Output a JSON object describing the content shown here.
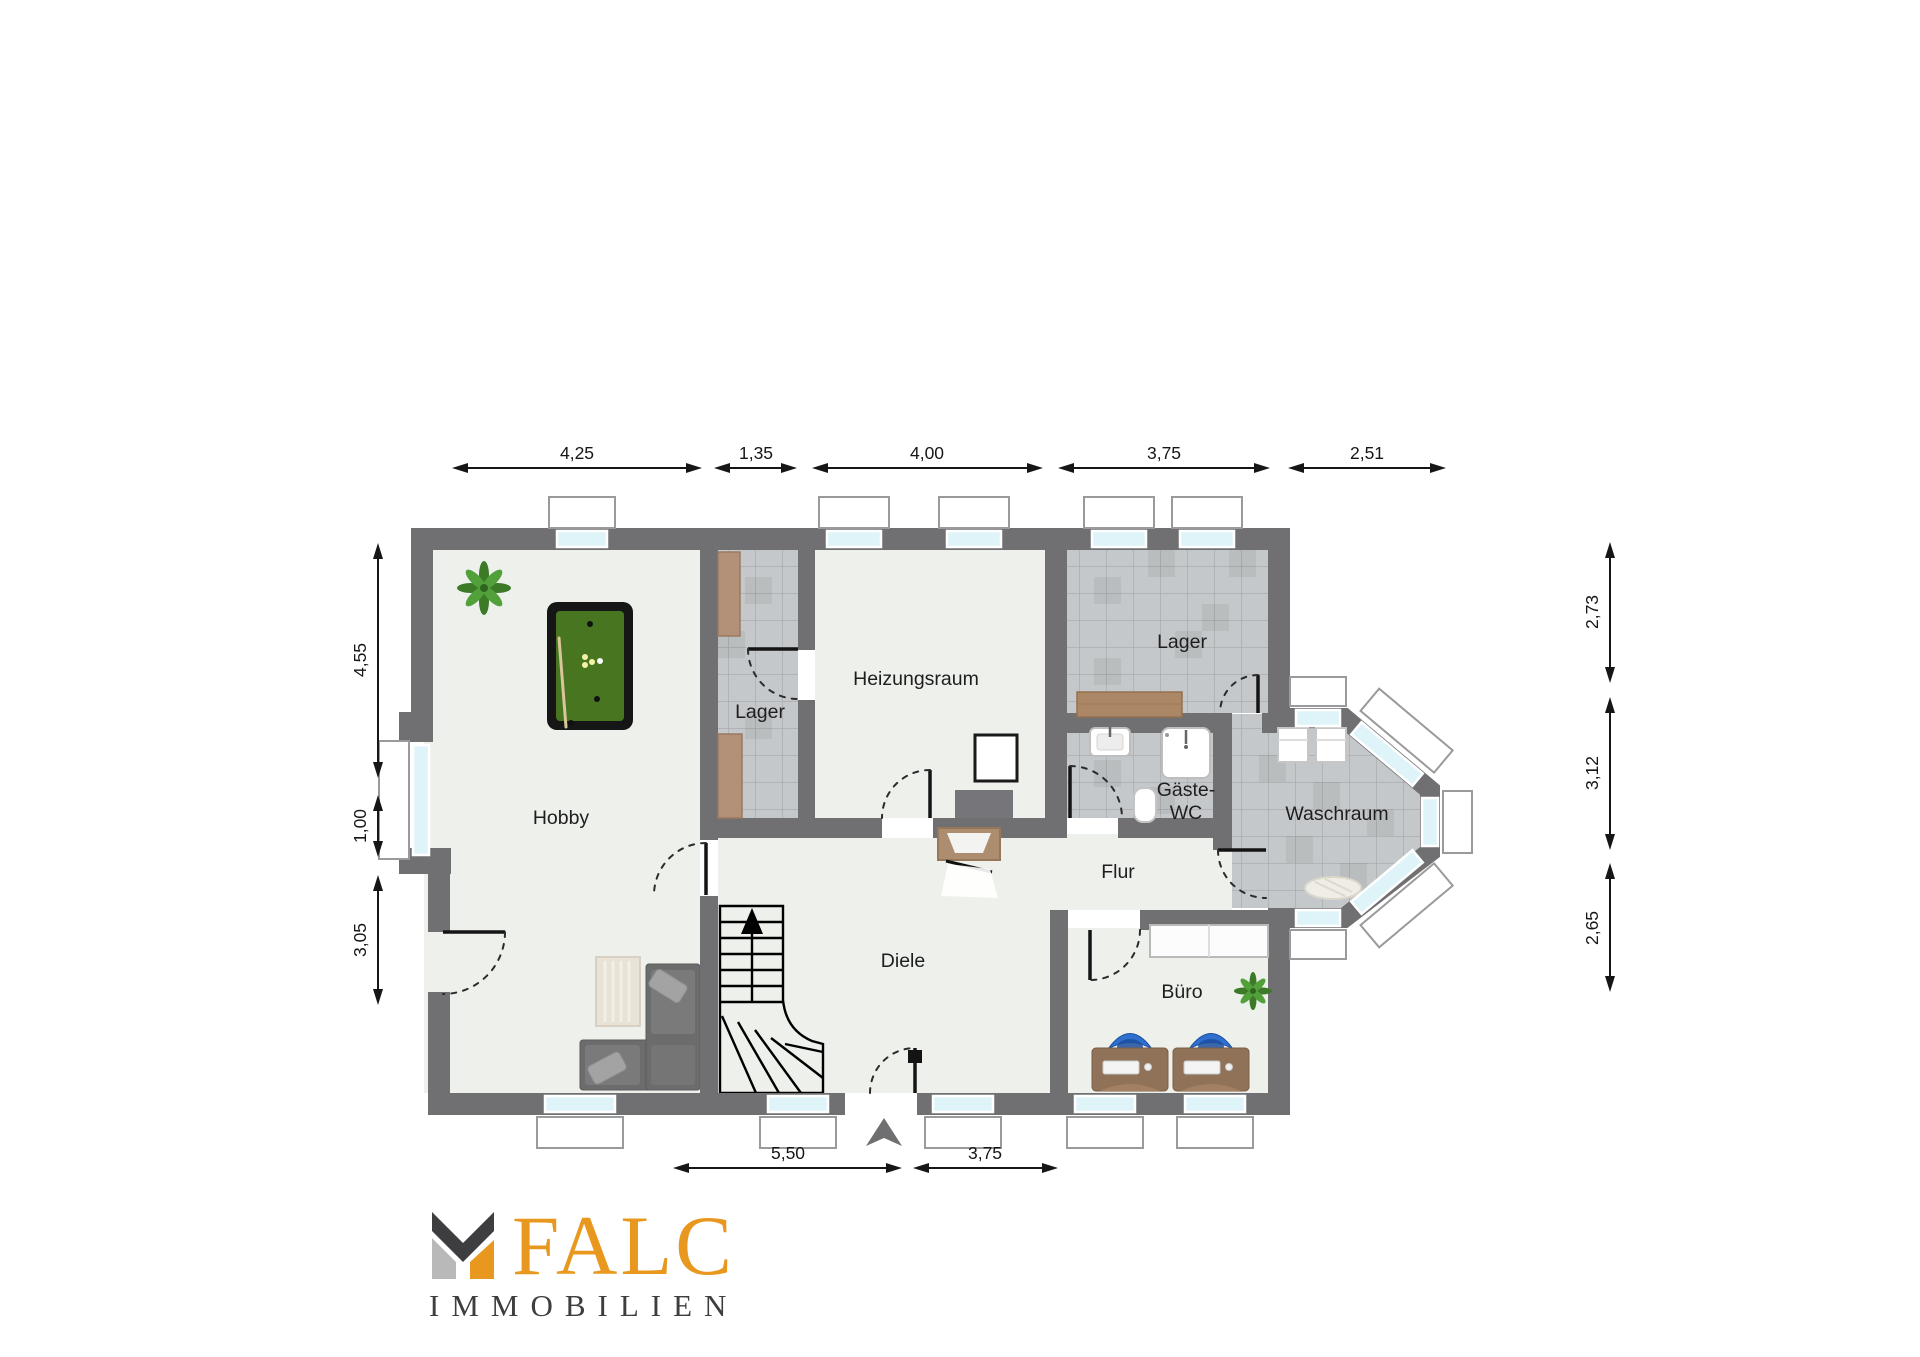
{
  "branding": {
    "logo_text": "FALC",
    "logo_subtitle": "IMMOBILIEN",
    "logo_orange": "#E8981E",
    "logo_dark": "#3E3E40",
    "logo_gray": "#B9B9BA"
  },
  "rooms": {
    "hobby": "Hobby",
    "lager_small": "Lager",
    "heizungsraum": "Heizungsraum",
    "lager_top": "Lager",
    "gaeste_wc_line1": "Gäste-",
    "gaeste_wc_line2": "WC",
    "waschraum": "Waschraum",
    "flur": "Flur",
    "diele": "Diele",
    "buero": "Büro"
  },
  "dimensions": {
    "top": [
      "4,25",
      "1,35",
      "4,00",
      "3,75",
      "2,51"
    ],
    "left": [
      "4,55",
      "1,00",
      "3,05"
    ],
    "right": [
      "2,73",
      "3,12",
      "2,65"
    ],
    "bottom": [
      "5,50",
      "3,75"
    ]
  },
  "colors": {
    "wall": "#707072",
    "floor": "#EEF0EB",
    "tile": "#C5C8CA",
    "window_glass": "#DFF4F9",
    "pool_table_green": "#477520",
    "desk_brown": "#8F7257",
    "chair_blue": "#2F6FCE"
  }
}
